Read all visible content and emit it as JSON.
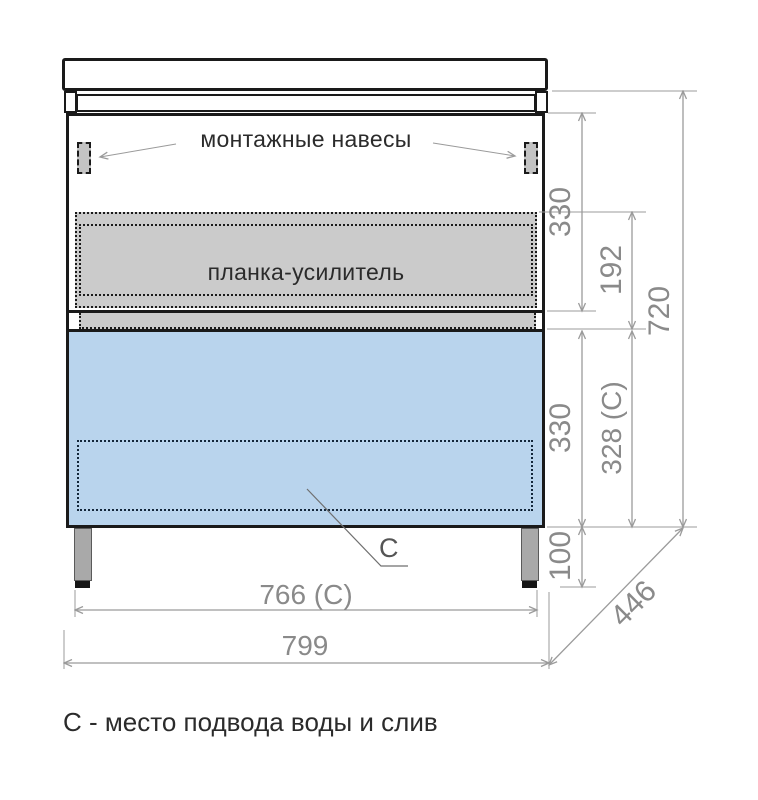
{
  "labels": {
    "mounting_hangers": "монтажные навесы",
    "reinforcement_bar": "планка-усилитель",
    "drain_marker": "С",
    "caption": "С - место подвода воды и слив"
  },
  "dimensions": {
    "upper_section_height": "330",
    "reinforcement_offset": "192",
    "cabinet_height": "720",
    "drawer_section_height": "330",
    "drain_zone_height": "328 (С)",
    "leg_height": "100",
    "depth": "446",
    "drain_zone_width": "766 (С)",
    "total_width": "799"
  },
  "colors": {
    "outline": "#1a1a1a",
    "dim_line": "#9b9b9b",
    "dim_text": "#8a8a8a",
    "label_text": "#2b2b2b",
    "panel_gray": "#cbcbcb",
    "hanger_gray": "#c3c3c3",
    "drawer_blue": "#b9d4ed",
    "leg_gray": "#a9a9a9",
    "leg_foot": "#161616",
    "leader_gray": "#9a9a9a",
    "drain_label": "#555555"
  }
}
